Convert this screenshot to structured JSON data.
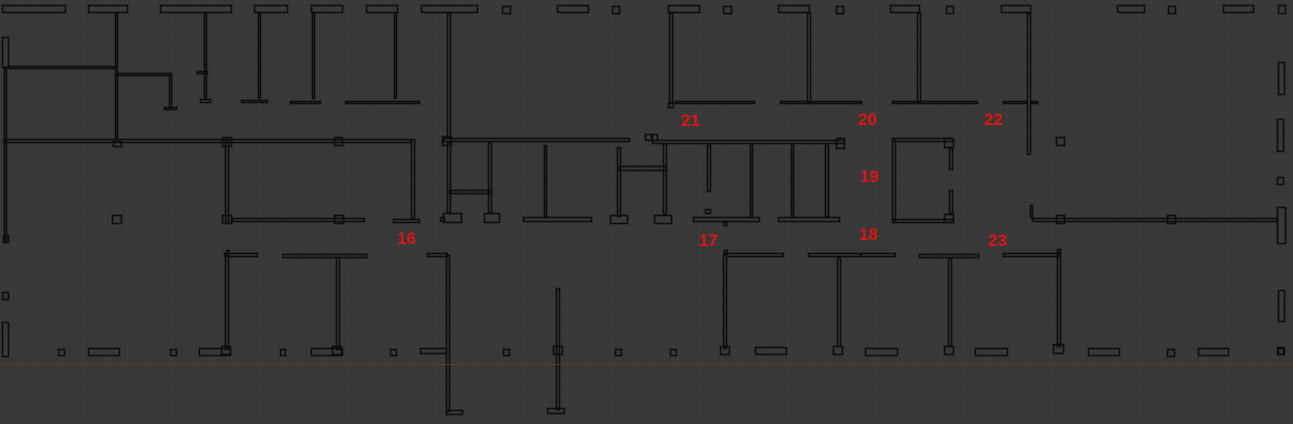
{
  "canvas": {
    "width": 1293,
    "height": 424,
    "background_color": "#383838",
    "wall_color": "#0d0d0d",
    "label_color": "#e01414",
    "grid": {
      "size": 22,
      "offset_x": 17,
      "offset_y": 2,
      "color": "#414141"
    },
    "guide_line": {
      "y": 364,
      "color": "#7c2823"
    }
  },
  "room_labels": [
    {
      "text": "16",
      "x": 397,
      "y": 229
    },
    {
      "text": "17",
      "x": 699,
      "y": 231
    },
    {
      "text": "18",
      "x": 859,
      "y": 225
    },
    {
      "text": "19",
      "x": 860,
      "y": 167
    },
    {
      "text": "20",
      "x": 858,
      "y": 110
    },
    {
      "text": "21",
      "x": 681,
      "y": 111
    },
    {
      "text": "22",
      "x": 984,
      "y": 110
    },
    {
      "text": "23",
      "x": 988,
      "y": 231
    }
  ],
  "walls": [
    [
      2,
      5,
      64,
      8
    ],
    [
      88,
      5,
      40,
      8
    ],
    [
      160,
      5,
      72,
      8
    ],
    [
      254,
      5,
      34,
      8
    ],
    [
      311,
      5,
      32,
      8
    ],
    [
      366,
      5,
      32,
      8
    ],
    [
      421,
      5,
      57,
      8
    ],
    [
      502,
      6,
      9,
      8
    ],
    [
      557,
      5,
      32,
      8
    ],
    [
      612,
      6,
      8,
      8
    ],
    [
      668,
      5,
      32,
      8
    ],
    [
      723,
      6,
      9,
      8
    ],
    [
      778,
      5,
      32,
      8
    ],
    [
      836,
      6,
      8,
      8
    ],
    [
      890,
      5,
      30,
      8
    ],
    [
      946,
      6,
      8,
      8
    ],
    [
      1001,
      5,
      30,
      8
    ],
    [
      1117,
      5,
      28,
      8
    ],
    [
      1168,
      6,
      8,
      8
    ],
    [
      1223,
      5,
      31,
      8
    ],
    [
      1278,
      5,
      8,
      9
    ],
    [
      115,
      13,
      3,
      127
    ],
    [
      204,
      13,
      3,
      87
    ],
    [
      200,
      99,
      11,
      4
    ],
    [
      197,
      71,
      11,
      3
    ],
    [
      258,
      13,
      3,
      86
    ],
    [
      241,
      100,
      27,
      3
    ],
    [
      312,
      13,
      3,
      86
    ],
    [
      290,
      101,
      31,
      3
    ],
    [
      394,
      13,
      3,
      86
    ],
    [
      345,
      101,
      75,
      3
    ],
    [
      447,
      13,
      4,
      125
    ],
    [
      669,
      13,
      4,
      90
    ],
    [
      675,
      101,
      80,
      3
    ],
    [
      668,
      103,
      6,
      5
    ],
    [
      807,
      13,
      4,
      90
    ],
    [
      780,
      101,
      82,
      3
    ],
    [
      917,
      13,
      4,
      90
    ],
    [
      892,
      101,
      86,
      3
    ],
    [
      1027,
      13,
      4,
      142
    ],
    [
      1003,
      101,
      24,
      3
    ],
    [
      1031,
      101,
      7,
      3
    ],
    [
      2,
      37,
      7,
      31
    ],
    [
      9,
      66,
      107,
      3
    ],
    [
      117,
      73,
      55,
      3
    ],
    [
      169,
      75,
      3,
      33
    ],
    [
      164,
      107,
      13,
      3
    ],
    [
      4,
      68,
      3,
      175
    ],
    [
      3,
      235,
      6,
      8
    ],
    [
      3,
      139,
      408,
      4
    ],
    [
      113,
      141,
      9,
      6
    ],
    [
      222,
      137,
      10,
      10
    ],
    [
      334,
      137,
      9,
      9
    ],
    [
      411,
      139,
      4,
      80
    ],
    [
      393,
      219,
      27,
      4
    ],
    [
      443,
      138,
      187,
      4
    ],
    [
      442,
      136,
      10,
      10
    ],
    [
      645,
      134,
      7,
      7
    ],
    [
      652,
      134,
      6,
      7
    ],
    [
      652,
      140,
      193,
      4
    ],
    [
      836,
      138,
      9,
      11
    ],
    [
      225,
      140,
      4,
      82
    ],
    [
      222,
      215,
      10,
      9
    ],
    [
      232,
      218,
      133,
      4
    ],
    [
      334,
      215,
      10,
      9
    ],
    [
      447,
      142,
      4,
      71
    ],
    [
      443,
      213,
      19,
      10
    ],
    [
      488,
      142,
      4,
      71
    ],
    [
      484,
      213,
      16,
      10
    ],
    [
      449,
      190,
      41,
      4
    ],
    [
      440,
      217,
      5,
      5
    ],
    [
      544,
      145,
      3,
      72
    ],
    [
      523,
      217,
      69,
      5
    ],
    [
      617,
      147,
      4,
      70
    ],
    [
      610,
      215,
      18,
      9
    ],
    [
      663,
      143,
      4,
      72
    ],
    [
      654,
      215,
      18,
      9
    ],
    [
      619,
      166,
      48,
      5
    ],
    [
      707,
      145,
      4,
      47
    ],
    [
      705,
      209,
      6,
      5
    ],
    [
      693,
      217,
      67,
      5
    ],
    [
      723,
      222,
      5,
      4
    ],
    [
      750,
      145,
      3,
      72
    ],
    [
      791,
      145,
      3,
      72
    ],
    [
      778,
      217,
      62,
      5
    ],
    [
      825,
      145,
      4,
      72
    ],
    [
      892,
      138,
      4,
      85
    ],
    [
      892,
      138,
      61,
      4
    ],
    [
      892,
      219,
      61,
      4
    ],
    [
      944,
      138,
      10,
      10
    ],
    [
      949,
      148,
      4,
      22
    ],
    [
      944,
      214,
      10,
      9
    ],
    [
      949,
      190,
      4,
      24
    ],
    [
      1032,
      218,
      246,
      4
    ],
    [
      1030,
      205,
      3,
      13
    ],
    [
      1056,
      215,
      9,
      9
    ],
    [
      1167,
      215,
      9,
      9
    ],
    [
      1277,
      207,
      9,
      37
    ],
    [
      1056,
      137,
      9,
      9
    ],
    [
      1278,
      62,
      7,
      33
    ],
    [
      1277,
      119,
      7,
      33
    ],
    [
      1277,
      177,
      7,
      8
    ],
    [
      1278,
      290,
      7,
      32
    ],
    [
      1277,
      347,
      7,
      8
    ],
    [
      112,
      215,
      10,
      9
    ],
    [
      224,
      253,
      34,
      4
    ],
    [
      226,
      250,
      4,
      4
    ],
    [
      225,
      255,
      4,
      95
    ],
    [
      221,
      346,
      10,
      9
    ],
    [
      282,
      254,
      86,
      4
    ],
    [
      336,
      257,
      4,
      93
    ],
    [
      332,
      346,
      10,
      9
    ],
    [
      427,
      253,
      21,
      4
    ],
    [
      446,
      255,
      4,
      157
    ],
    [
      446,
      410,
      17,
      5
    ],
    [
      420,
      348,
      27,
      6
    ],
    [
      556,
      288,
      4,
      122
    ],
    [
      547,
      408,
      18,
      6
    ],
    [
      553,
      346,
      10,
      9
    ],
    [
      724,
      250,
      4,
      4
    ],
    [
      726,
      253,
      58,
      4
    ],
    [
      723,
      254,
      4,
      95
    ],
    [
      720,
      346,
      10,
      9
    ],
    [
      755,
      347,
      32,
      8
    ],
    [
      808,
      253,
      53,
      4
    ],
    [
      837,
      257,
      4,
      90
    ],
    [
      833,
      346,
      10,
      9
    ],
    [
      861,
      253,
      35,
      4
    ],
    [
      919,
      254,
      60,
      4
    ],
    [
      948,
      258,
      4,
      89
    ],
    [
      944,
      346,
      10,
      9
    ],
    [
      1003,
      253,
      57,
      4
    ],
    [
      1057,
      249,
      4,
      4
    ],
    [
      1057,
      253,
      4,
      94
    ],
    [
      1053,
      344,
      11,
      10
    ],
    [
      58,
      349,
      7,
      7
    ],
    [
      88,
      348,
      32,
      8
    ],
    [
      170,
      349,
      7,
      7
    ],
    [
      199,
      348,
      32,
      8
    ],
    [
      280,
      349,
      6,
      7
    ],
    [
      311,
      348,
      32,
      8
    ],
    [
      390,
      349,
      7,
      7
    ],
    [
      503,
      349,
      7,
      7
    ],
    [
      615,
      349,
      7,
      7
    ],
    [
      670,
      349,
      7,
      7
    ],
    [
      865,
      348,
      33,
      8
    ],
    [
      975,
      348,
      33,
      8
    ],
    [
      1088,
      348,
      32,
      8
    ],
    [
      1167,
      349,
      8,
      8
    ],
    [
      1198,
      348,
      31,
      8
    ],
    [
      1278,
      348,
      7,
      7
    ],
    [
      2,
      292,
      7,
      8
    ],
    [
      2,
      322,
      7,
      35
    ]
  ]
}
